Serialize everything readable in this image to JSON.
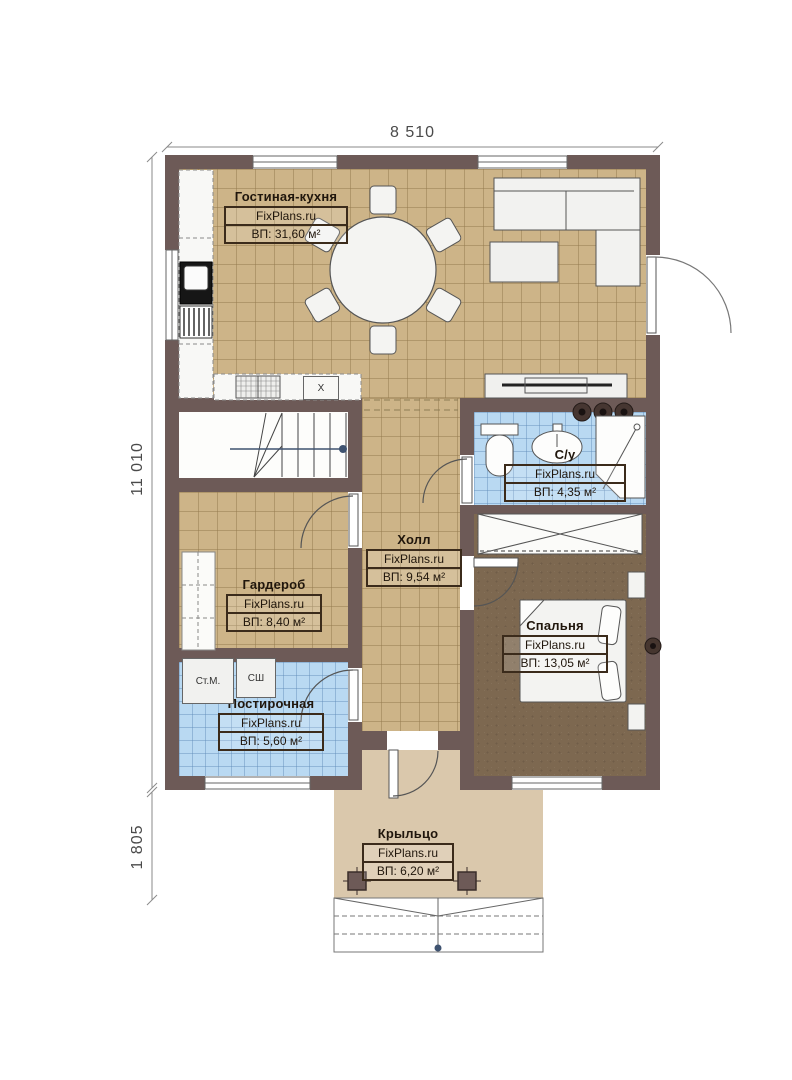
{
  "brand": "FixPlans.ru",
  "dimensions": {
    "width_top": "8 510",
    "height_main": "11 010",
    "height_porch": "1 805"
  },
  "rooms": {
    "living": {
      "name": "Гостиная-кухня",
      "area": "ВП: 31,60 м²"
    },
    "bathroom": {
      "name": "С/у",
      "area": "ВП: 4,35 м²"
    },
    "hall": {
      "name": "Холл",
      "area": "ВП: 9,54 м²"
    },
    "wardrobe": {
      "name": "Гардероб",
      "area": "ВП: 8,40 м²"
    },
    "bedroom": {
      "name": "Спальня",
      "area": "ВП: 13,05 м²"
    },
    "laundry": {
      "name": "Постирочная",
      "area": "ВП: 5,60 м²"
    },
    "porch": {
      "name": "Крыльцо",
      "area": "ВП: 6,20 м²"
    }
  },
  "labels": {
    "washing_machine": "Ст.М.",
    "drying_cabinet": "СШ",
    "kitchen_unit": "X"
  },
  "colors": {
    "wall": "#6d5a57",
    "floor_tan": "#cdb488",
    "floor_tile_blue": "#b9d9f2",
    "floor_carpet": "#7d6850",
    "floor_porch": "#dac8ac",
    "label_border": "#3b2b1b",
    "arrow_accent": "#3f5370"
  }
}
